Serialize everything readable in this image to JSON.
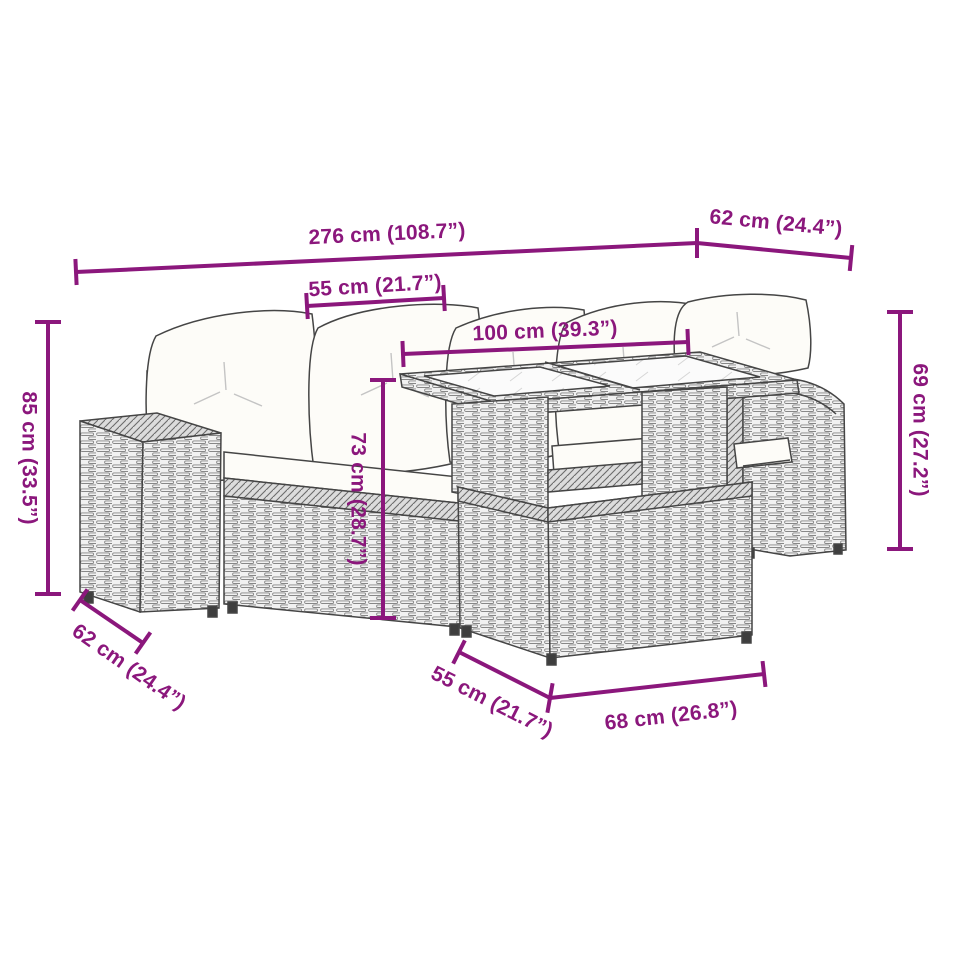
{
  "diagram": {
    "title": "garden furniture set dimension diagram",
    "accent_color": "#8B177C",
    "furniture_line_color": "#454545",
    "labels": {
      "total_width": "276 cm (108.7”)",
      "side_depth_top": "62 cm (24.4”)",
      "seat_width_top": "55 cm (21.7”)",
      "table_width": "100 cm (39.3”)",
      "sofa_height": "85 cm (33.5”)",
      "table_height": "73 cm (28.7”)",
      "chair_height": "69 cm (27.2”)",
      "sofa_depth_bottom": "62 cm (24.4”)",
      "table_base_depth": "55 cm (21.7”)",
      "table_base_width": "68 cm (26.8”)"
    }
  }
}
